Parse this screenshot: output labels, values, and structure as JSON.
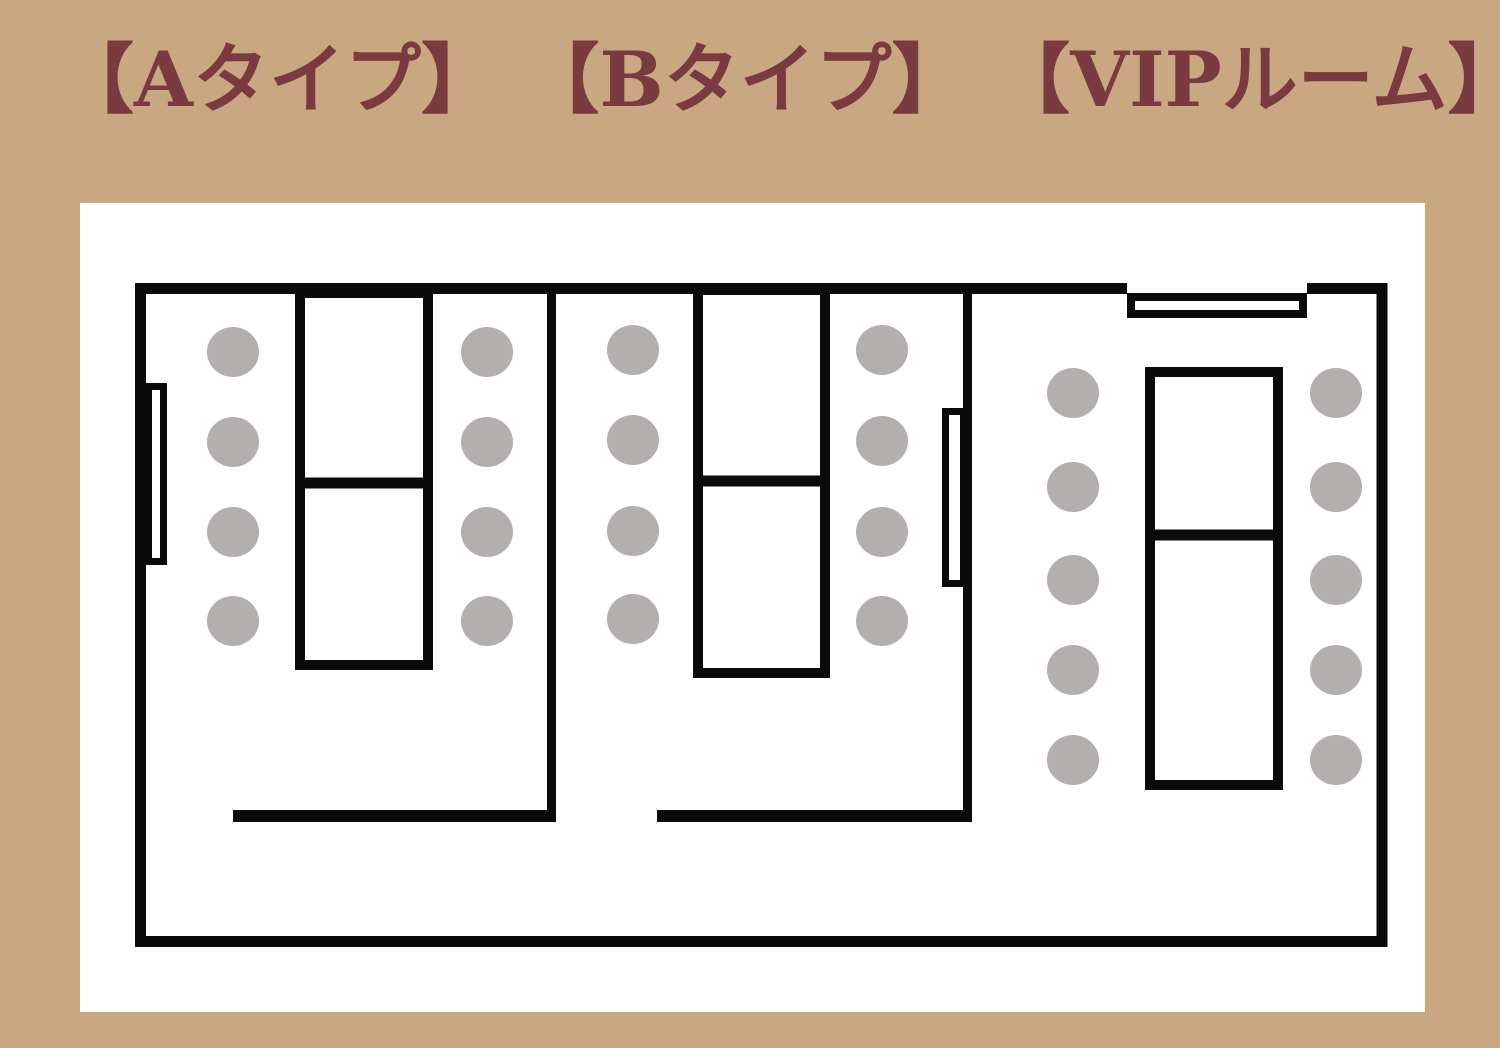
{
  "title": {
    "full_text": "【Aタイプ】 【Bタイプ】 【VIPルーム】",
    "segments": [
      "【Aタイプ】",
      "【Bタイプ】",
      "【VIPルーム】"
    ],
    "color": "#7a3b40"
  },
  "colors": {
    "background": "#c9a780",
    "panel": "#ffffff",
    "line": "#0a0a0a",
    "chair": "#b2afae"
  },
  "rooms": [
    {
      "id": "a",
      "label": "Aタイプ",
      "chairs": 8,
      "tables": 2
    },
    {
      "id": "b",
      "label": "Bタイプ",
      "chairs": 8,
      "tables": 2
    },
    {
      "id": "vip",
      "label": "VIPルーム",
      "chairs": 10,
      "tables": 2
    }
  ],
  "floor_plan": {
    "canvas": {
      "width": 1500,
      "height": 1048
    },
    "panel": {
      "x": 80,
      "y": 203,
      "width": 1345,
      "height": 809
    },
    "walls": [
      {
        "name": "outer-wall",
        "kind": "rect",
        "x": 140.5,
        "y": 288.5,
        "w": 1241.5,
        "h": 653,
        "stroke": 11
      },
      {
        "name": "divider-wall-a-b",
        "kind": "line",
        "x1": 551.5,
        "y1": 283,
        "x2": 551.5,
        "y2": 822,
        "stroke": 9
      },
      {
        "name": "divider-wall-b-vip",
        "kind": "line",
        "x1": 967.5,
        "y1": 283,
        "x2": 967.5,
        "y2": 822,
        "stroke": 9
      },
      {
        "name": "partition-line-a",
        "kind": "line",
        "x1": 233,
        "y1": 816,
        "x2": 556,
        "y2": 816,
        "stroke": 12
      },
      {
        "name": "partition-line-b",
        "kind": "line",
        "x1": 657,
        "y1": 816,
        "x2": 972,
        "y2": 816,
        "stroke": 12
      }
    ],
    "wall_gaps": [
      {
        "name": "vip-entrance-wall-gap",
        "x": 1127,
        "y": 282,
        "w": 180,
        "h": 12
      }
    ],
    "doors": [
      {
        "name": "door-room-a",
        "x": 148.5,
        "y": 386.5,
        "w": 15,
        "h": 175,
        "stroke": 7
      },
      {
        "name": "door-room-b",
        "x": 945.5,
        "y": 411.5,
        "w": 18,
        "h": 172,
        "stroke": 7
      },
      {
        "name": "door-vip-entrance",
        "x": 1131,
        "y": 297,
        "w": 172,
        "h": 17,
        "stroke": 8
      }
    ],
    "tables": [
      {
        "name": "table-a",
        "x": 300,
        "y": 293,
        "w": 128,
        "h": 372,
        "divider_y": 483,
        "stroke": 10
      },
      {
        "name": "table-b",
        "x": 698,
        "y": 290,
        "w": 127,
        "h": 383,
        "divider_y": 481,
        "stroke": 10
      },
      {
        "name": "table-vip",
        "x": 1150,
        "y": 372,
        "w": 128,
        "h": 413,
        "divider_y": 535,
        "stroke": 10
      }
    ],
    "chairs": {
      "rx": 26,
      "ry": 25,
      "columns": [
        {
          "name": "chairs-a-left",
          "cx": 233,
          "cys": [
            352,
            442,
            532,
            621
          ]
        },
        {
          "name": "chairs-a-right",
          "cx": 487,
          "cys": [
            352,
            442,
            532,
            621
          ]
        },
        {
          "name": "chairs-b-left",
          "cx": 633,
          "cys": [
            350,
            440,
            531,
            619
          ]
        },
        {
          "name": "chairs-b-right",
          "cx": 882,
          "cys": [
            350,
            441,
            532,
            621
          ]
        },
        {
          "name": "chairs-vip-left",
          "cx": 1073,
          "cys": [
            393,
            487,
            580,
            670,
            760
          ]
        },
        {
          "name": "chairs-vip-right",
          "cx": 1336,
          "cys": [
            393,
            487,
            580,
            670,
            760
          ]
        }
      ]
    }
  }
}
